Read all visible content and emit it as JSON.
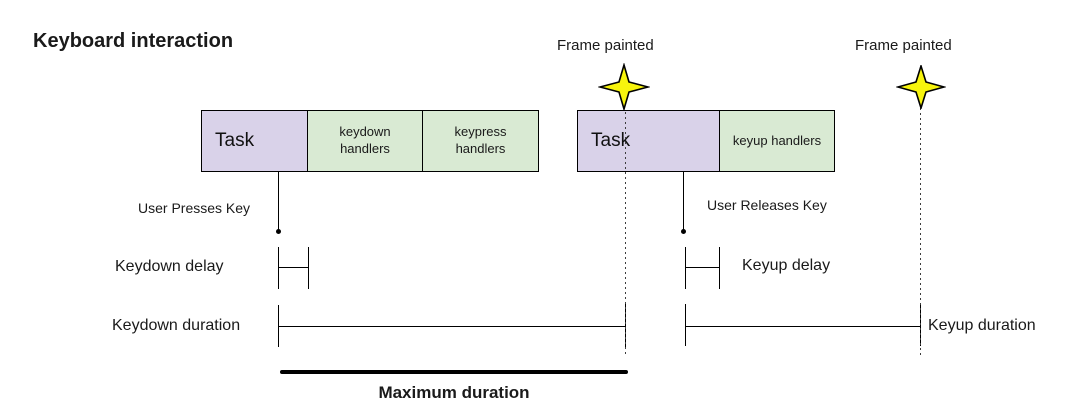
{
  "title": "Keyboard interaction",
  "colors": {
    "task_fill": "#d9d2e9",
    "handlers_fill": "#d9ead3",
    "star_fill": "#f7f40d",
    "line_color": "#000000",
    "background": "#ffffff"
  },
  "frame_painted_labels": [
    "Frame painted",
    "Frame painted"
  ],
  "keydown_group": {
    "task_label": "Task",
    "handlers": [
      "keydown handlers",
      "keypress handlers"
    ]
  },
  "keyup_group": {
    "task_label": "Task",
    "handlers": [
      "keyup handlers"
    ]
  },
  "labels": {
    "user_presses_key": "User Presses Key",
    "user_releases_key": "User Releases Key",
    "keydown_delay": "Keydown delay",
    "keyup_delay": "Keyup delay",
    "keydown_duration": "Keydown duration",
    "keyup_duration": "Keyup duration",
    "maximum_duration": "Maximum duration"
  }
}
